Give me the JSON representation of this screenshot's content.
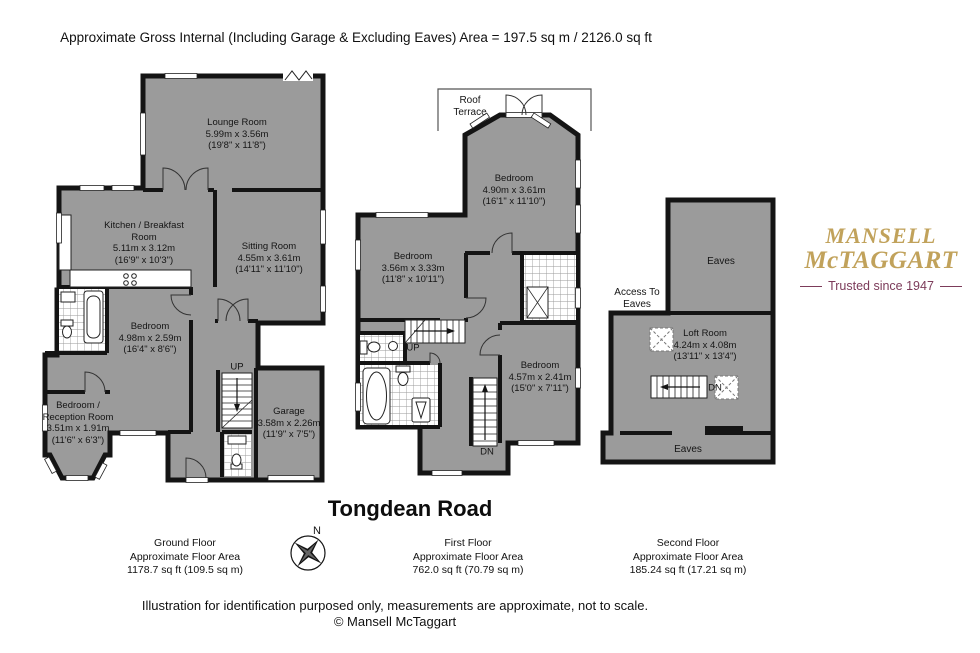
{
  "header": {
    "area_summary": "Approximate Gross Internal (Including Garage & Excluding Eaves) Area = 197.5 sq m / 2126.0 sq ft"
  },
  "title": "Tongdean Road",
  "compass": {
    "north": "N"
  },
  "logo": {
    "name_line1": "MANSELL",
    "name_line2": "McTAGGART",
    "tagline": "Trusted since 1947",
    "gold": "#C1A25B",
    "maroon": "#7C3B5A"
  },
  "colors": {
    "wall": "#141414",
    "room_fill": "#9b9b9b",
    "background": "#ffffff"
  },
  "annotations": {
    "up_ground": "UP",
    "up_first": "UP",
    "dn_first": "DN",
    "dn_second": "DN",
    "roof_terrace": "Roof Terrace",
    "access_to_eaves": "Access To Eaves",
    "eaves_top": "Eaves",
    "eaves_bottom": "Eaves"
  },
  "floors": [
    {
      "name": "Ground Floor",
      "area_label": "Approximate Floor Area",
      "area": "1178.7 sq ft (109.5 sq m)",
      "rooms": [
        {
          "name": "Lounge Room",
          "metric": "5.99m x 3.56m",
          "imperial": "(19'8\" x 11'8\")"
        },
        {
          "name": "Kitchen / Breakfast Room",
          "metric": "5.11m x 3.12m",
          "imperial": "(16'9\" x 10'3\")"
        },
        {
          "name": "Sitting Room",
          "metric": "4.55m x 3.61m",
          "imperial": "(14'11\" x 11'10\")"
        },
        {
          "name": "Bedroom",
          "metric": "4.98m x 2.59m",
          "imperial": "(16'4\" x 8'6\")"
        },
        {
          "name": "Bedroom / Reception Room",
          "metric": "3.51m x 1.91m",
          "imperial": "(11'6\" x 6'3\")"
        },
        {
          "name": "Garage",
          "metric": "3.58m x 2.26m",
          "imperial": "(11'9\" x 7'5\")"
        }
      ]
    },
    {
      "name": "First Floor",
      "area_label": "Approximate Floor Area",
      "area": "762.0 sq ft (70.79 sq m)",
      "rooms": [
        {
          "name": "Bedroom",
          "metric": "4.90m x 3.61m",
          "imperial": "(16'1\" x 11'10\")"
        },
        {
          "name": "Bedroom",
          "metric": "3.56m x 3.33m",
          "imperial": "(11'8\" x 10'11\")"
        },
        {
          "name": "Bedroom",
          "metric": "4.57m x 2.41m",
          "imperial": "(15'0\" x 7'11\")"
        }
      ]
    },
    {
      "name": "Second Floor",
      "area_label": "Approximate Floor Area",
      "area": "185.24 sq ft (17.21 sq m)",
      "rooms": [
        {
          "name": "Loft Room",
          "metric": "4.24m x 4.08m",
          "imperial": "(13'11\" x 13'4\")"
        }
      ]
    }
  ],
  "footer": {
    "disclaimer": "Illustration for identification purposed only, measurements are approximate, not to scale.",
    "copyright": "© Mansell McTaggart"
  }
}
